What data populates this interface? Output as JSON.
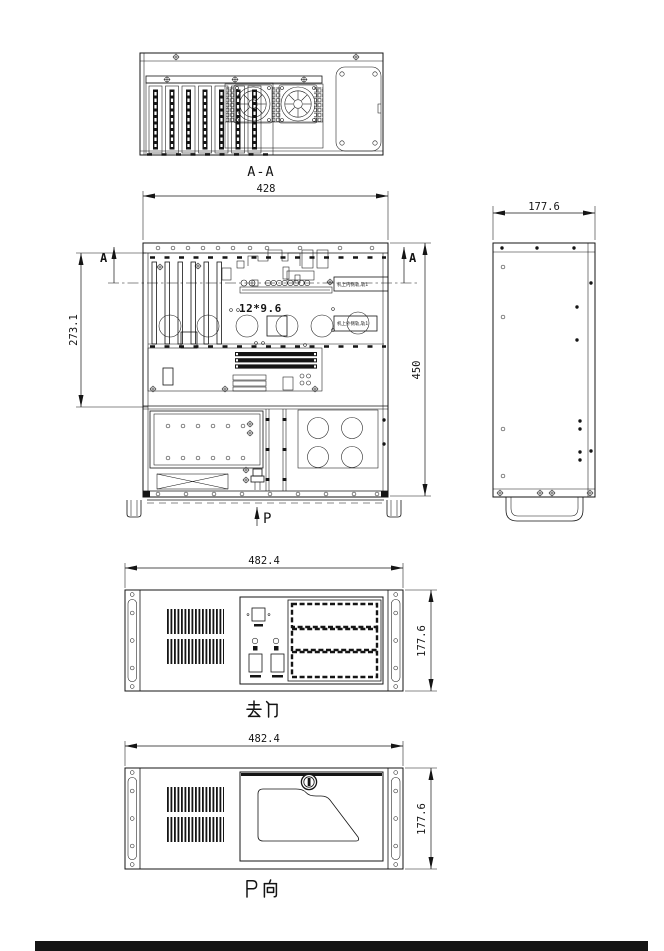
{
  "page": {
    "background": "#ffffff",
    "line_color": "#151515"
  },
  "views": {
    "section_aa": {
      "label": "A-A"
    },
    "top_view": {
      "dim_width": "428",
      "dim_height_total": "450",
      "dim_height_partial": "273.1",
      "section_marker_left": "A",
      "section_marker_right": "A",
      "hole_note": "12*9.6",
      "rail_note_upper": "机上内侧轨,轨1",
      "rail_note_lower": "机上外侧轨,轨1",
      "direction_label": "P"
    },
    "side_view": {
      "dim_width": "177.6"
    },
    "front_no_door": {
      "label": "去门",
      "dim_width": "482.4",
      "dim_height": "177.6"
    },
    "front_door": {
      "label": "P向",
      "dim_width": "482.4",
      "dim_height": "177.6"
    }
  }
}
